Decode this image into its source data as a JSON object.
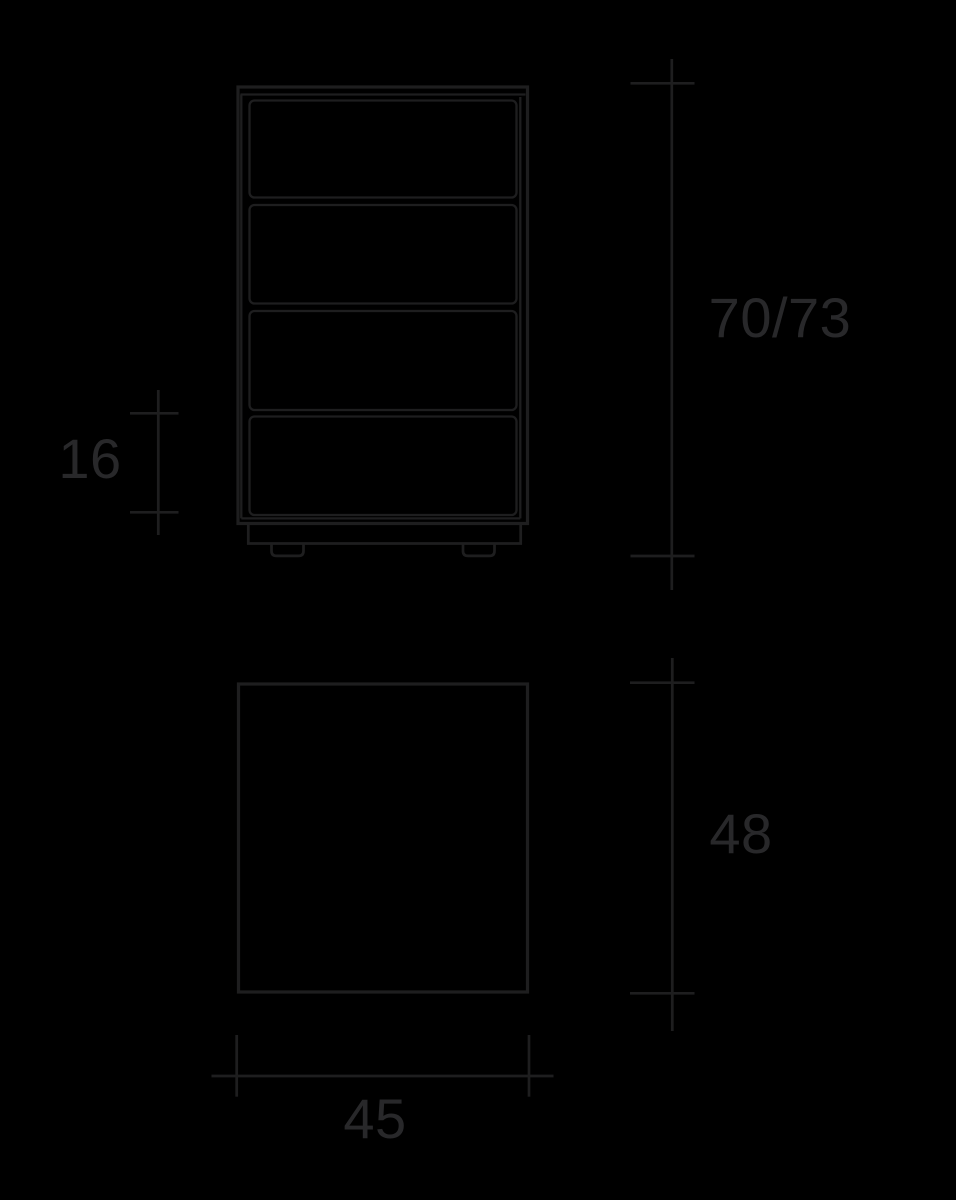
{
  "background_color": "#000000",
  "line_color": "#1e1e1f",
  "label_color": "#28282a",
  "drawing": {
    "type": "furniture-dimension-diagram",
    "views": {
      "front": {
        "name": "front view of four-drawer cabinet on plinth feet",
        "drawer_count": 4
      },
      "plan": {
        "name": "plan (top) view rectangle"
      }
    },
    "dimensions": {
      "height": {
        "label": "70/73",
        "orientation": "vertical",
        "position": "right of front view"
      },
      "drawer_front_height": {
        "label": "16",
        "orientation": "vertical",
        "position": "left of front view"
      },
      "depth": {
        "label": "48",
        "orientation": "vertical",
        "position": "right of plan view"
      },
      "width": {
        "label": "45",
        "orientation": "horizontal",
        "position": "below plan view"
      }
    }
  }
}
